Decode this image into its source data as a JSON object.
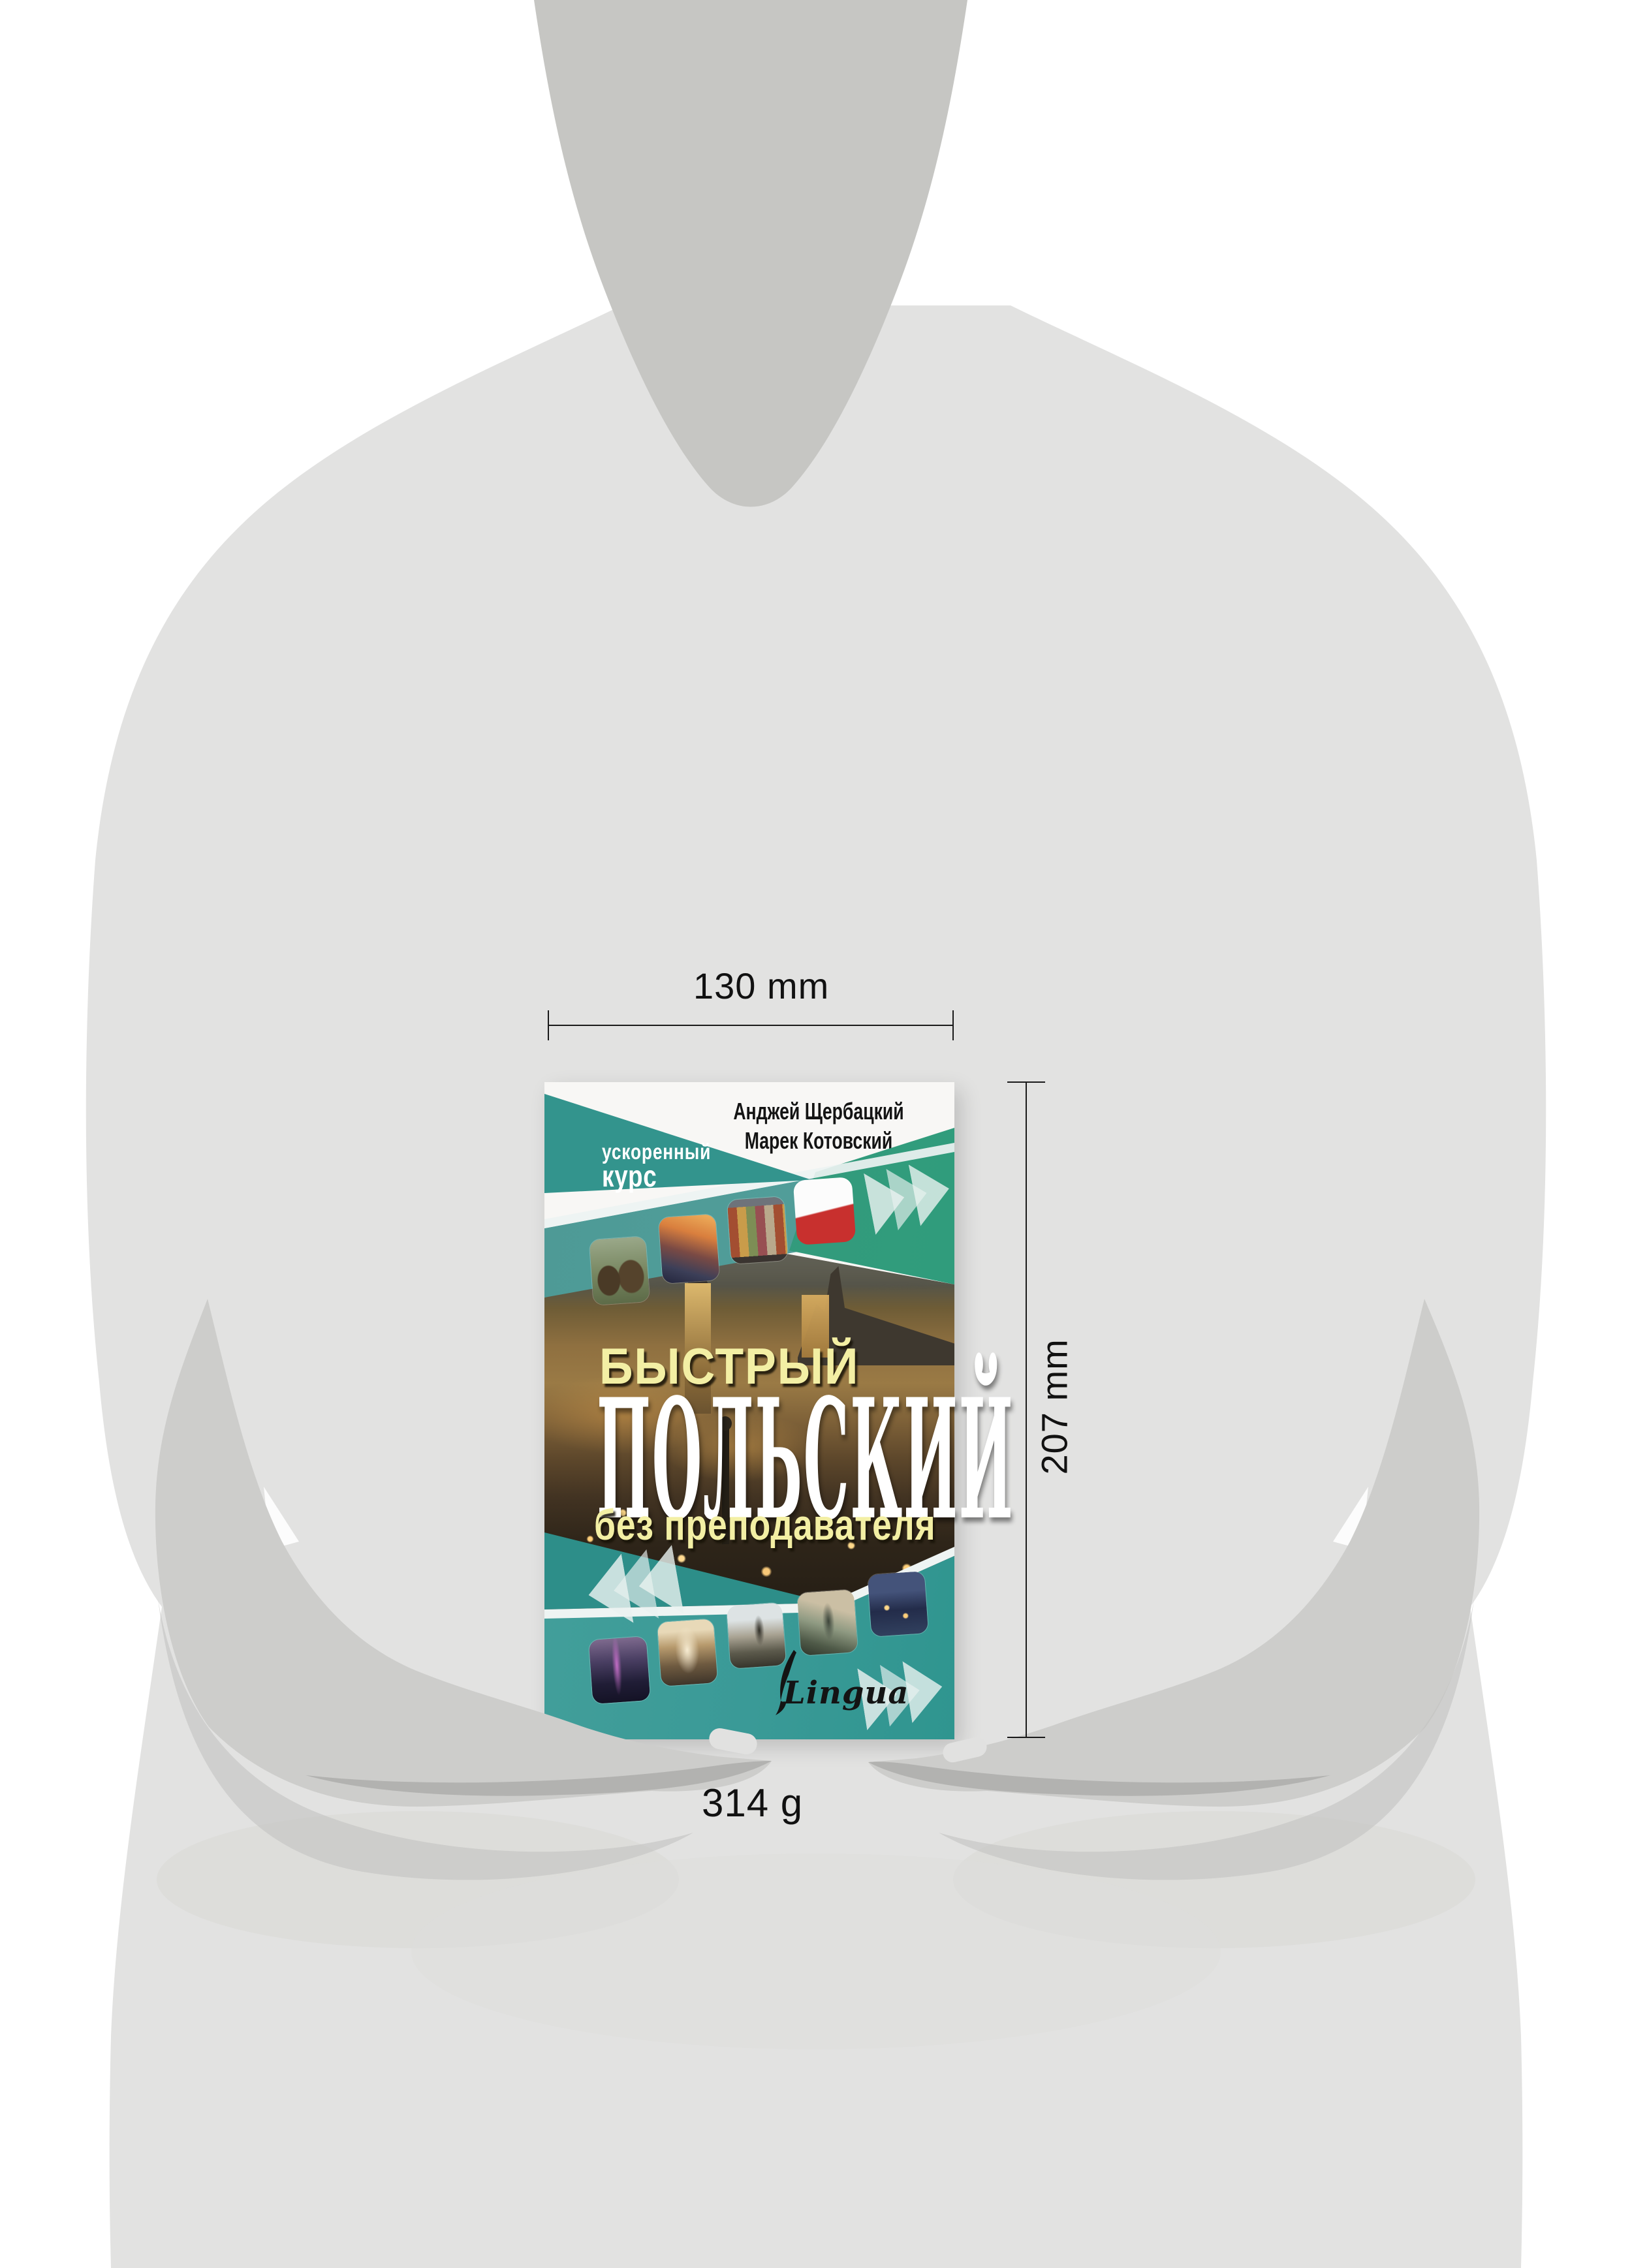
{
  "annotations": {
    "width_label": "130 mm",
    "height_label": "207 mm",
    "weight_label": "314 g"
  },
  "book": {
    "authors": [
      "Анджей Щербацкий",
      "Марек Котовский"
    ],
    "badge": {
      "line1": "ускоренный",
      "line2": "курс"
    },
    "title": {
      "line1": "БЫСТРЫЙ",
      "line2": "ПОЛЬСКИЙ",
      "line3": "без преподавателя"
    },
    "publisher_logo": "Lingua",
    "cover_top_thumbnails": [
      "bison",
      "bridge-sunset",
      "old-townhouses",
      "poland-flag"
    ],
    "cover_bottom_thumbnails": [
      "city-skyline-night",
      "old-town-street",
      "fountain-statue",
      "copernicus-monument",
      "city-aerial-night"
    ]
  },
  "palette": {
    "teal_band": "#4d9a96",
    "teal_wedge": "#33948d",
    "green_band": "#2f9d7b",
    "teal_dark": "#2d8e89",
    "teal_bottom": "#45a09b",
    "flag_red": "#c8302e",
    "title_yellow": "#f3efa4",
    "silhouette_light": "#e2e2e1",
    "silhouette_mid": "#cdcdcb",
    "silhouette_dark": "#c6c6c3"
  }
}
